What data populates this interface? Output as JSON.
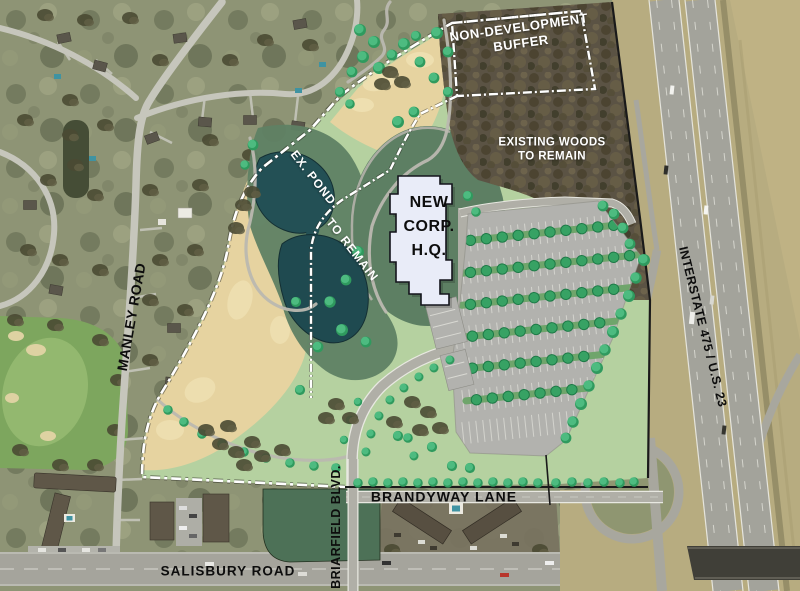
{
  "labels": {
    "buffer_line1": "NON-DEVELOPMENT",
    "buffer_line2": "BUFFER",
    "woods_line1": "EXISTING WOODS",
    "woods_line2": "TO REMAIN",
    "hq_line1": "NEW",
    "hq_line2": "CORP.",
    "hq_line3": "H.Q.",
    "pond_line1": "EX. POND",
    "pond_line2": "TO REMAIN",
    "manley_road": "MANLEY ROAD",
    "interstate": "INTERSTATE 475 / U.S. 23",
    "brandyway_lane": "BRANDYWAY LANE",
    "briarfield_blvd": "BRIARFIELD BLVD.",
    "salisbury_road": "SALISBURY ROAD"
  },
  "colors": {
    "site_lawn": "#b5d1a0",
    "meadow_tan": "#e6d3a0",
    "dark_green": "#5d7f63",
    "pond_teal": "#235055",
    "woods_brown": "#5b5344",
    "tree_green": "#37a264",
    "parking_gray": "#b2b2ae",
    "building_white": "#e9ecf8",
    "boundary_dash_white": "#ffffff",
    "boundary_black": "#1a1a1a",
    "road_gray": "#b0afa7",
    "aerial_olive": "#8e9475",
    "farmland_tan": "#b7ac80",
    "label_black": "#111111",
    "label_white": "#ffffff"
  }
}
